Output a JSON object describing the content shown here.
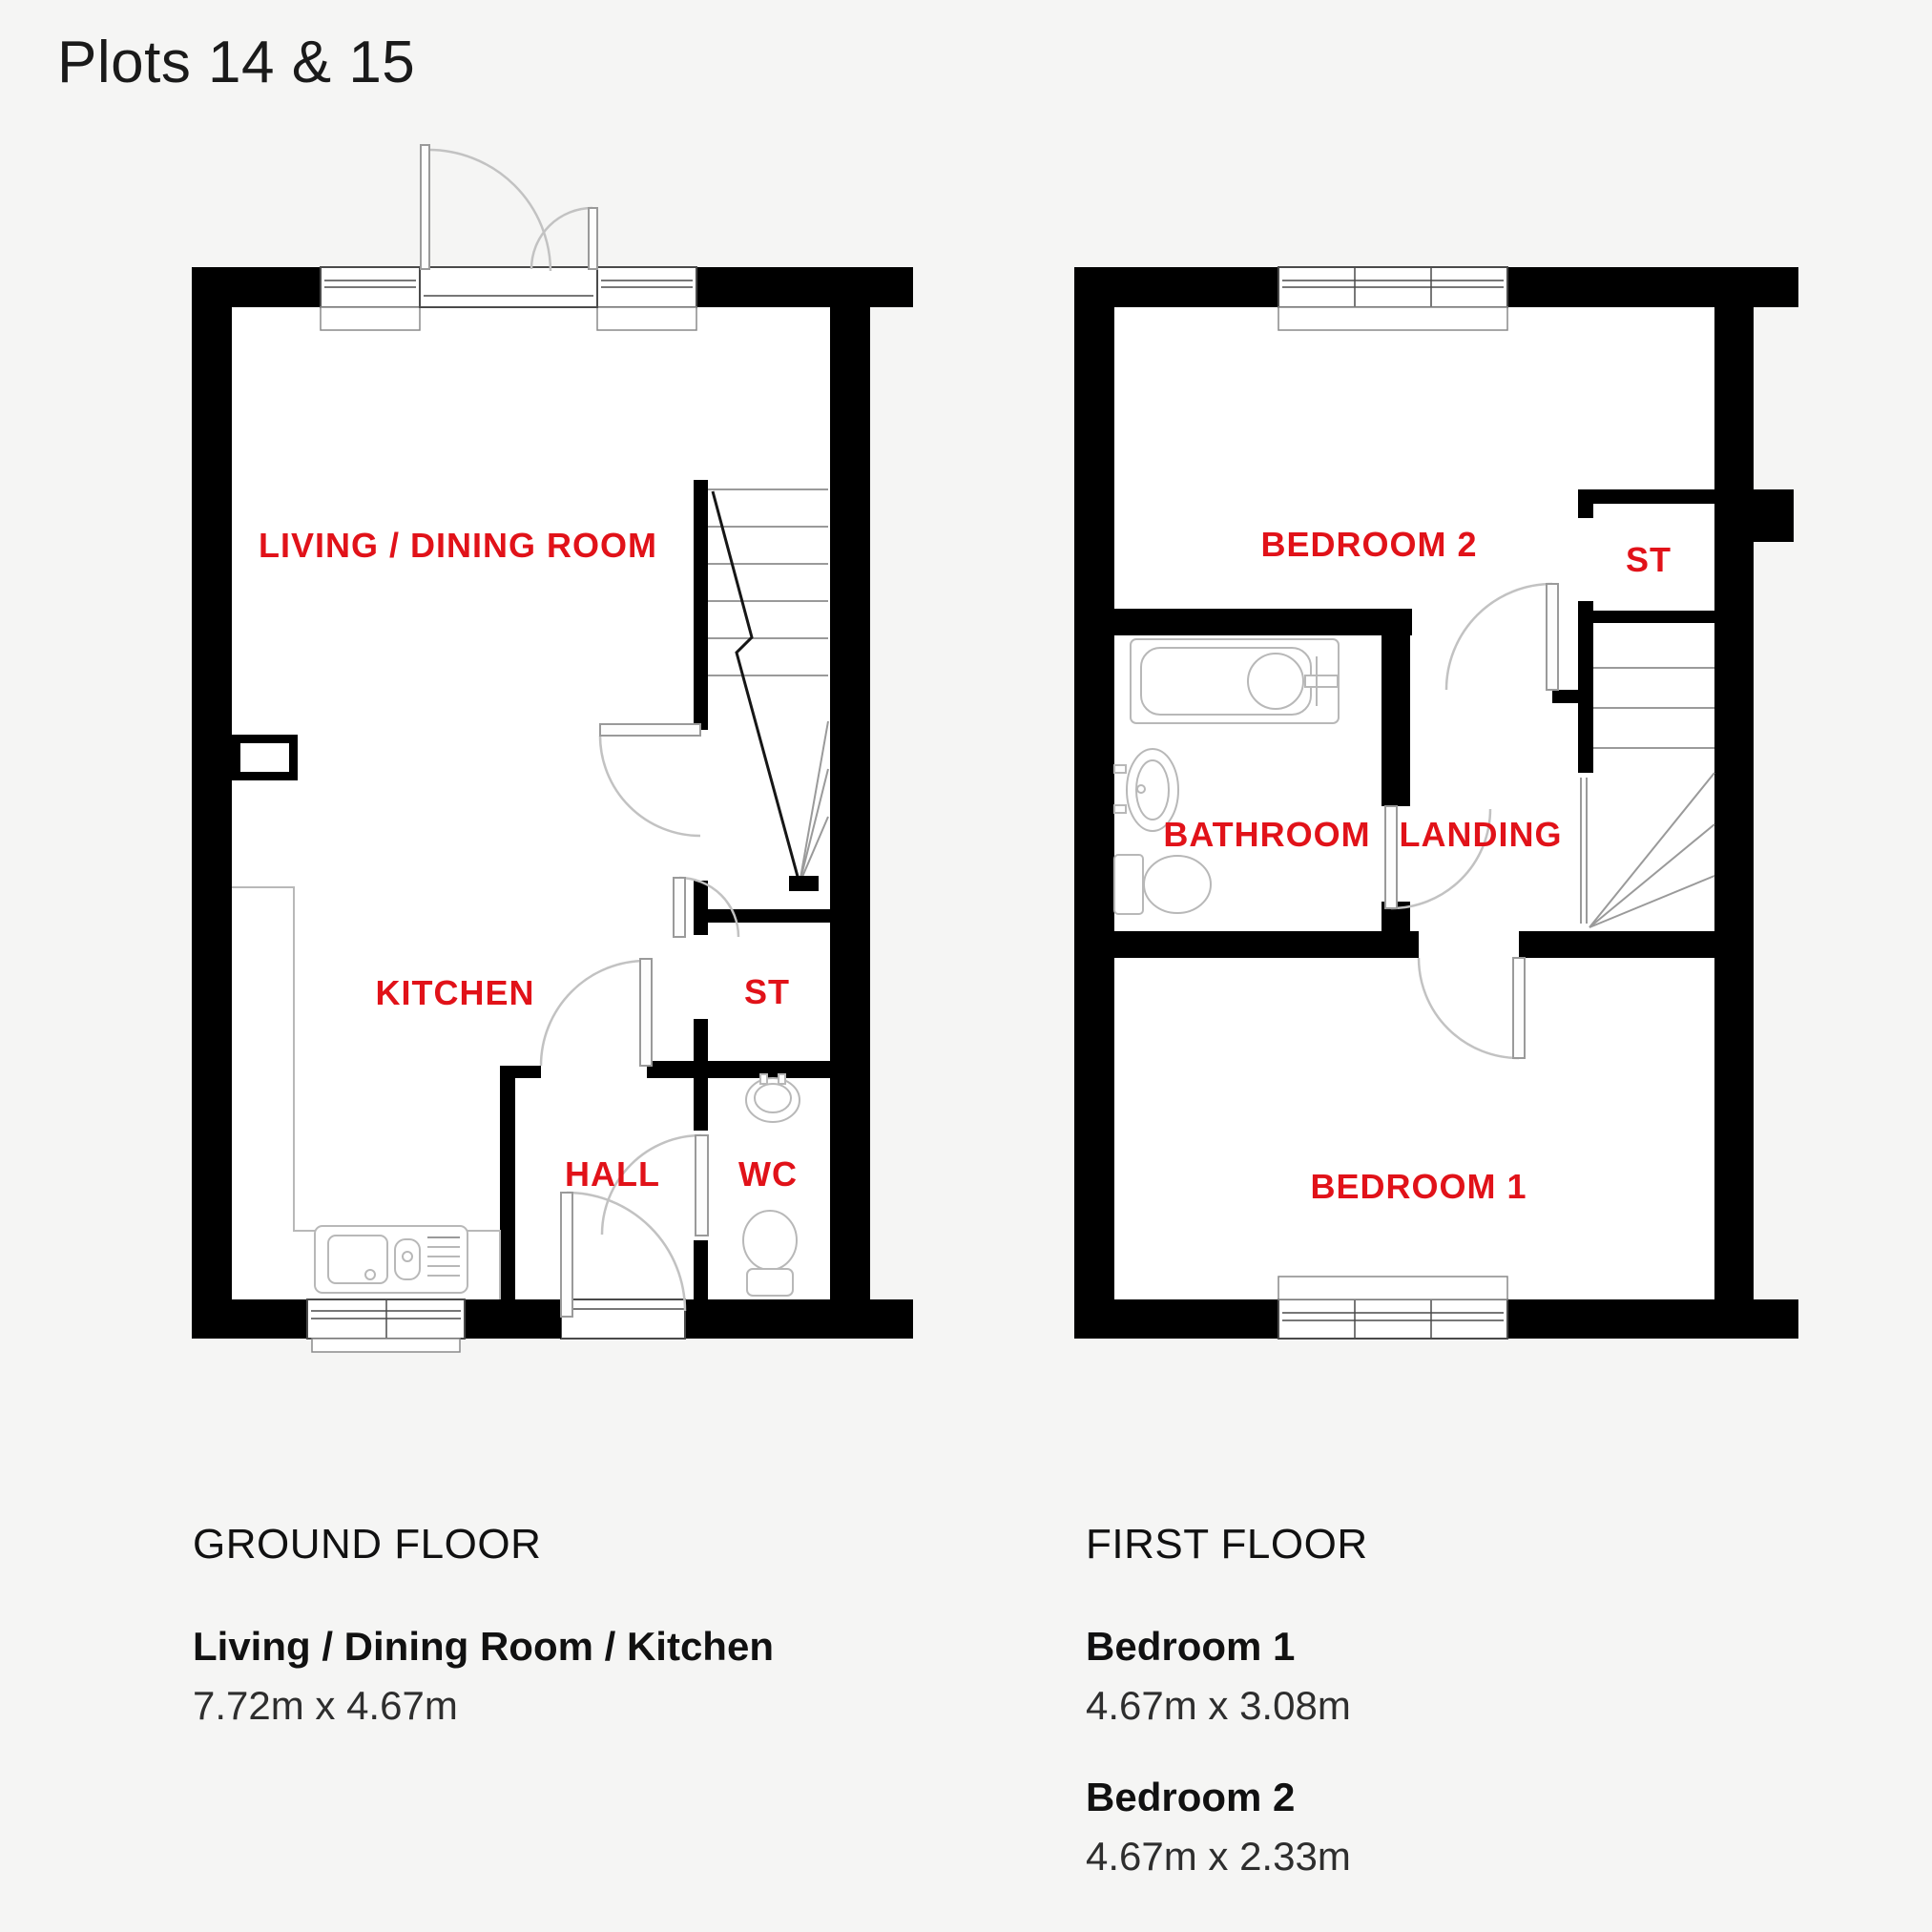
{
  "page": {
    "title": "Plots 14 & 15",
    "background_color": "#f5f5f4",
    "label_color": "#e11219",
    "wall_color": "#000000",
    "text_color": "#1a1a1a"
  },
  "ground_floor": {
    "rooms": [
      {
        "id": "living-dining-room",
        "label": "LIVING / DINING ROOM"
      },
      {
        "id": "kitchen",
        "label": "KITCHEN"
      },
      {
        "id": "storage",
        "label": "ST"
      },
      {
        "id": "hall",
        "label": "HALL"
      },
      {
        "id": "wc",
        "label": "WC"
      }
    ],
    "caption": {
      "heading": "GROUND FLOOR",
      "items": [
        {
          "name": "Living / Dining Room / Kitchen",
          "dims": "7.72m x 4.67m"
        }
      ]
    }
  },
  "first_floor": {
    "rooms": [
      {
        "id": "bedroom-2",
        "label": "BEDROOM 2"
      },
      {
        "id": "storage",
        "label": "ST"
      },
      {
        "id": "bathroom",
        "label": "BATHROOM"
      },
      {
        "id": "landing",
        "label": "LANDING"
      },
      {
        "id": "bedroom-1",
        "label": "BEDROOM 1"
      }
    ],
    "caption": {
      "heading": "FIRST FLOOR",
      "items": [
        {
          "name": "Bedroom 1",
          "dims": "4.67m x 3.08m"
        },
        {
          "name": "Bedroom 2",
          "dims": "4.67m x 2.33m"
        }
      ]
    }
  }
}
